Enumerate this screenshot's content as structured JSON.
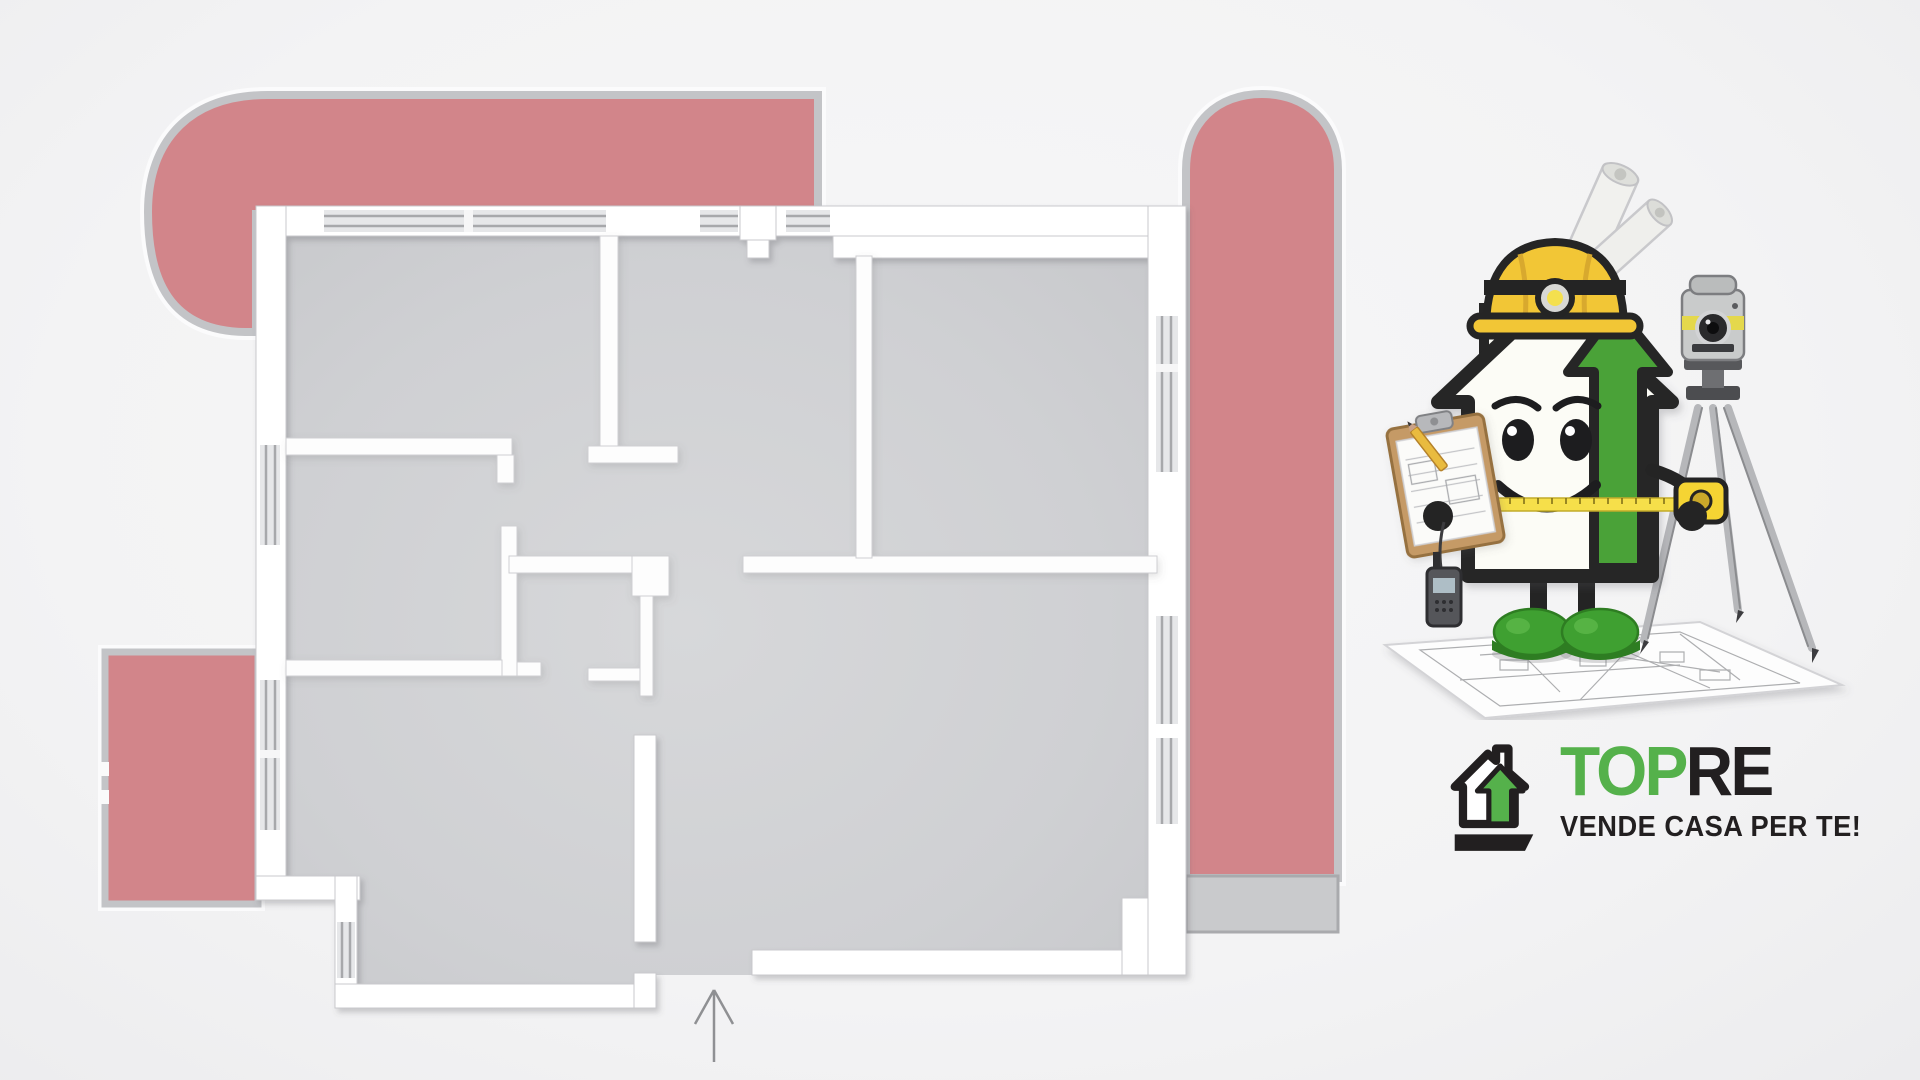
{
  "logo": {
    "top": "TOP",
    "re": "RE",
    "tagline": "VENDE CASA PER TE!"
  },
  "colors": {
    "terrace_pink": "#d2858a",
    "terrace_rim": "#c3c4c7",
    "terrace_foot": "#c9cacc",
    "floor_gray": "#cfd0d3",
    "wall_white": "#ffffff",
    "glass_line": "#a7a8ab",
    "logo_green": "#55b14b",
    "logo_black": "#221f20",
    "helmet_yellow": "#f2c636",
    "boot_green": "#3fa031",
    "bg": "#f4f4f5"
  }
}
